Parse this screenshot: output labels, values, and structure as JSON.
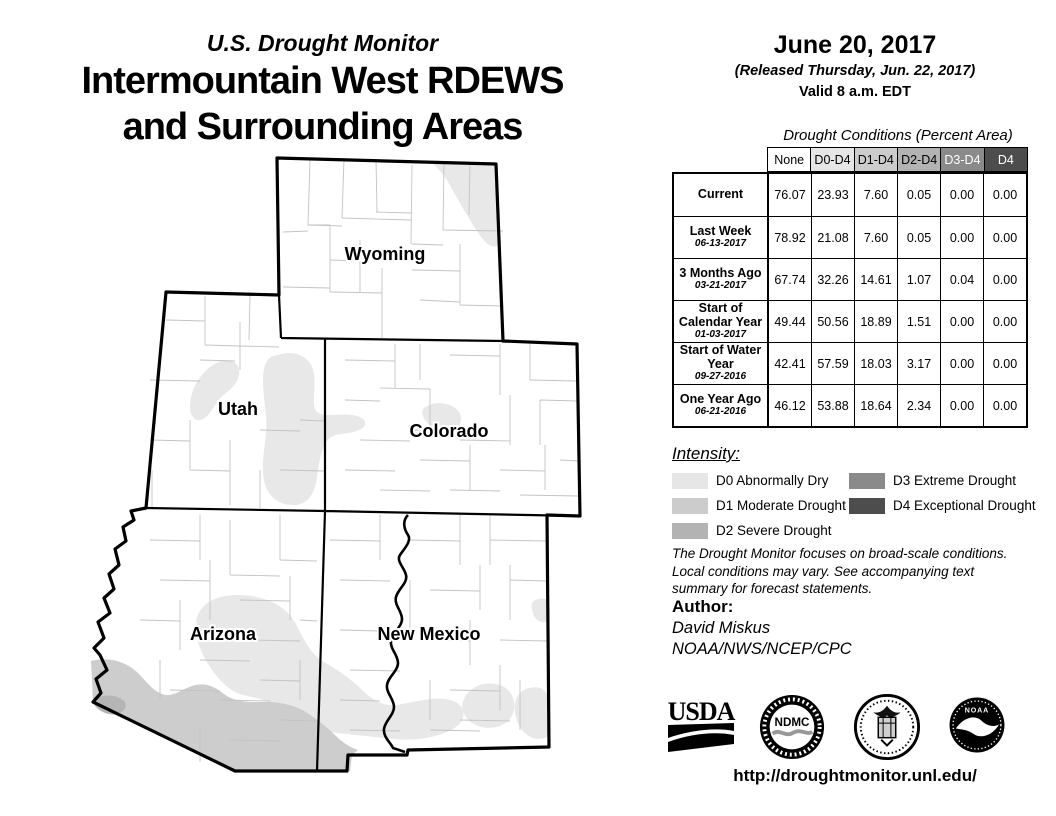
{
  "title": {
    "kicker": "U.S. Drought Monitor",
    "line1": "Intermountain West RDEWS",
    "line2": "and Surrounding Areas"
  },
  "date_block": {
    "date": "June 20, 2017",
    "released": "(Released Thursday, Jun. 22, 2017)",
    "valid": "Valid 8 a.m. EDT"
  },
  "map": {
    "labels": {
      "wyoming": "Wyoming",
      "utah": "Utah",
      "colorado": "Colorado",
      "arizona": "Arizona",
      "new_mexico": "New Mexico"
    }
  },
  "table": {
    "caption": "Drought Conditions (Percent Area)",
    "columns": [
      "None",
      "D0-D4",
      "D1-D4",
      "D2-D4",
      "D3-D4",
      "D4"
    ],
    "rows": [
      {
        "label": "Current",
        "date": "",
        "values": [
          "76.07",
          "23.93",
          "7.60",
          "0.05",
          "0.00",
          "0.00"
        ]
      },
      {
        "label": "Last Week",
        "date": "06-13-2017",
        "values": [
          "78.92",
          "21.08",
          "7.60",
          "0.05",
          "0.00",
          "0.00"
        ]
      },
      {
        "label": "3 Months Ago",
        "date": "03-21-2017",
        "values": [
          "67.74",
          "32.26",
          "14.61",
          "1.07",
          "0.04",
          "0.00"
        ]
      },
      {
        "label": "Start of Calendar Year",
        "date": "01-03-2017",
        "values": [
          "49.44",
          "50.56",
          "18.89",
          "1.51",
          "0.00",
          "0.00"
        ]
      },
      {
        "label": "Start of Water Year",
        "date": "09-27-2016",
        "values": [
          "42.41",
          "57.59",
          "18.03",
          "3.17",
          "0.00",
          "0.00"
        ]
      },
      {
        "label": "One Year Ago",
        "date": "06-21-2016",
        "values": [
          "46.12",
          "53.88",
          "18.64",
          "2.34",
          "0.00",
          "0.00"
        ]
      }
    ]
  },
  "legend": {
    "heading": "Intensity:",
    "items": [
      {
        "code": "D0",
        "label": "D0 Abnormally Dry",
        "color": "#e6e6e6"
      },
      {
        "code": "D1",
        "label": "D1 Moderate Drought",
        "color": "#cccccc"
      },
      {
        "code": "D2",
        "label": "D2 Severe Drought",
        "color": "#b3b3b3"
      },
      {
        "code": "D3",
        "label": "D3 Extreme Drought",
        "color": "#8a8a8a"
      },
      {
        "code": "D4",
        "label": "D4 Exceptional Drought",
        "color": "#4d4d4d"
      }
    ]
  },
  "disclaimer": "The Drought Monitor focuses on broad-scale conditions. Local conditions may vary. See accompanying text summary for forecast statements.",
  "author": {
    "heading": "Author:",
    "name": "David Miskus",
    "org": "NOAA/NWS/NCEP/CPC"
  },
  "logos": {
    "usda": "USDA",
    "ndmc": "NDMC",
    "noaa": "NOAA"
  },
  "url": "http://droughtmonitor.unl.edu/",
  "colors": {
    "d0": "#e6e6e6",
    "d1": "#cccccc",
    "d2": "#b3b3b3",
    "d3": "#8a8a8a",
    "d4": "#4d4d4d",
    "map_d0": "#e8e8e8",
    "map_d1": "#cdcdcd",
    "map_d2": "#b5b5b5"
  }
}
